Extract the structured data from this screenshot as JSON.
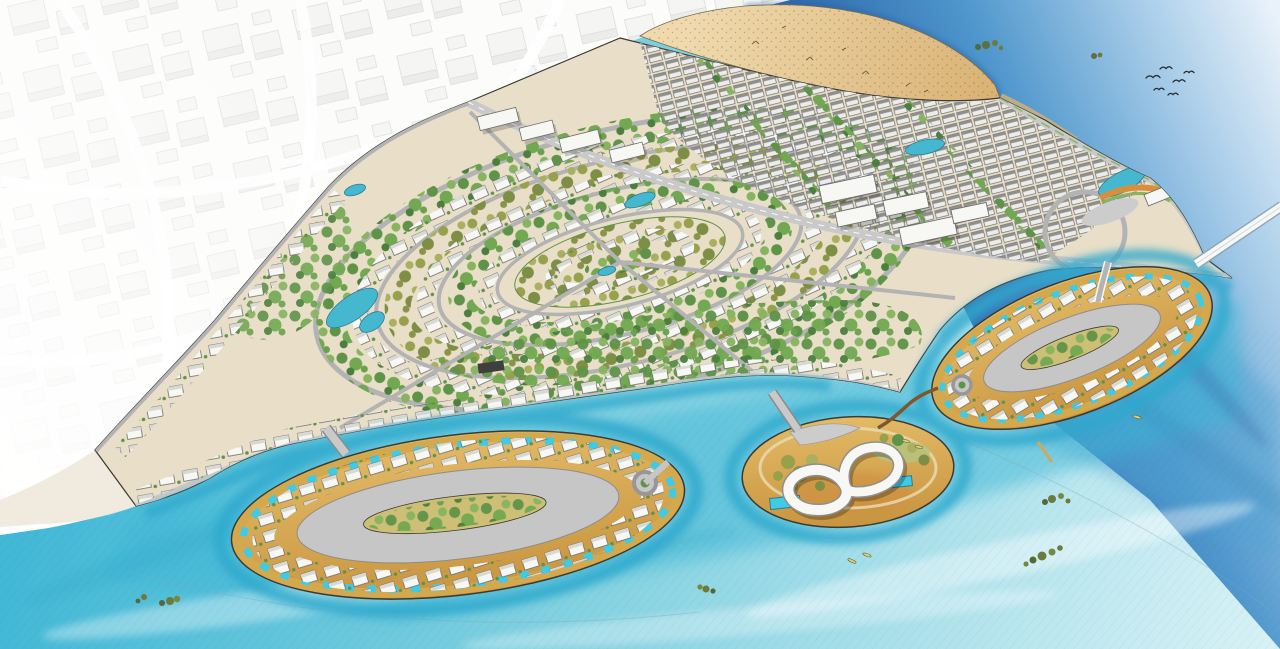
{
  "scene": {
    "kind": "waterfront-masterplan-aerial-illustration",
    "regions": [
      "city-context",
      "beach",
      "open-sea",
      "mainland-development",
      "central-park-loops",
      "townhouse-grid",
      "office-blocks",
      "island-west",
      "island-round",
      "island-east",
      "landmark-building"
    ],
    "icons": [
      "birds-icon",
      "boat-icon",
      "mangrove-icon",
      "pool-icon",
      "roundabout-icon",
      "bridge-icon",
      "infinity-building-icon",
      "pond-icon"
    ],
    "counts": {
      "islands": 3,
      "bridges": 5,
      "bird_flock_birds": 6,
      "boats": 5
    }
  },
  "colors": {
    "paper": "#fbfbf9",
    "city_line": "#cfcfcc",
    "city_fill": "#f0f0ee",
    "city_fill2": "#e2e2df",
    "water_bright": "#3ab5d5",
    "water_mid": "#7fd0e0",
    "water_pale": "#d9f2f6",
    "canal": "#2fa8cc",
    "sea_deep": "#2f6cae",
    "sea_mid": "#4f97cd",
    "sea_pale": "#e9f2fa",
    "sea_streak": "#2a5f9e",
    "sand_light": "#efd9ad",
    "sand_mid": "#d9b274",
    "sand_rim": "#d4a94e",
    "island_sand": "#e3ba66",
    "island_sand_dark": "#c8943f",
    "green_bright": "#86b45f",
    "green_mid": "#5e9348",
    "green_dark": "#3f7039",
    "olive": "#97a04b",
    "lawn_tan": "#cdbf76",
    "road_grey": "#b3b3b3",
    "road_light": "#c9c9c9",
    "asphalt": "#c6c6c6",
    "plaza_grey": "#cccccc",
    "path_cream": "#e9dfc9",
    "bldg_white": "#f7f7f4",
    "bldg_stroke": "#6e6e6e",
    "roof_dark": "#8f8f8b",
    "pool": "#3fcbe6",
    "pond": "#45b8d0",
    "bridge_wood": "#82552c",
    "accent_orange": "#d98e3a",
    "outline_dark": "#3a3a33",
    "bird_dark": "#2a2a2a",
    "boat_yellow": "#d8d06a"
  }
}
